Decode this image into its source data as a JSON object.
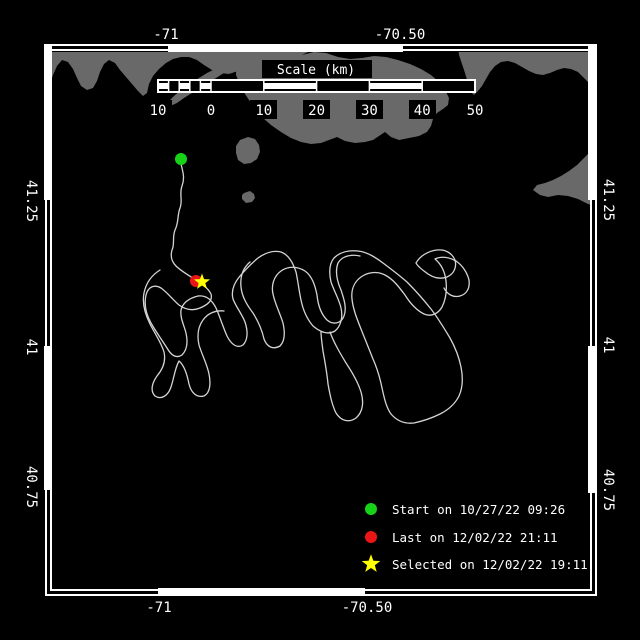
{
  "axes": {
    "top": [
      "-71",
      "-70.50"
    ],
    "bottom": [
      "-71",
      "-70.50"
    ],
    "left": [
      "41.25",
      "41",
      "40.75"
    ],
    "right": [
      "41.25",
      "41",
      "40.75"
    ]
  },
  "scale_bar": {
    "title": "Scale (km)",
    "tick_labels": [
      "10",
      "0",
      "10",
      "20",
      "30",
      "40",
      "50"
    ]
  },
  "legend": {
    "items": [
      {
        "marker": "green-dot",
        "label": "Start on 10/27/22 09:26"
      },
      {
        "marker": "red-dot",
        "label": "Last on 12/02/22 21:11"
      },
      {
        "marker": "yellow-star",
        "label": "Selected on 12/02/22 19:11"
      }
    ]
  },
  "markers": {
    "start": {
      "transform": "translate(181,159)"
    },
    "last": {
      "transform": "translate(196,281)"
    },
    "selected": {
      "transform": "translate(202,282)"
    }
  },
  "colors": {
    "background": "#000000",
    "frame": "#ffffff",
    "land": "#696969",
    "track": "#d4d4d4",
    "start_green": "#17d317",
    "last_red": "#ea1616",
    "selected_yellow": "#ffff00",
    "text": "#ffffff"
  },
  "geometry": {
    "land": [
      "47,48 312,48 308,52 300,56 292,59 283,58 273,56 263,58 254,62 246,67 238,71 229,74 220,73 212,70 204,65 197,60 189,57 181,57 173,59 166,63 159,69 153,76 149,84 147,93 143,96 138,91 132,84 126,77 120,70 115,63 109,60 104,64 100,72 97,81 93,88 87,90 81,86 77,78 73,69 68,62 62,60 57,66 53,75 50,84 47,91",
      "168,102 175,95 183,89 191,83 199,78 207,73 215,69 223,65 230,62 235,64 231,69 224,73 216,78 208,83 200,88 192,93 184,98 177,103 170,106",
      "236,64 244,58 254,54 266,52 278,53 290,56 302,55 314,52 326,53 338,57 350,59 362,58 374,56 386,57 398,60 410,64 421,69 431,75 439,82 445,90 449,98 448,105 443,109 437,113 433,119 431,126 427,132 419,136 409,138 399,140 391,137 385,132 379,136 373,140 365,142 355,143 345,141 337,137 329,140 321,143 311,144 301,142 291,138 281,132 271,125 263,118 257,111 251,103 245,94 240,85 236,75",
      "458,48 596,48 596,88 590,84 584,78 578,72 571,69 564,68 557,70 550,73 543,75 536,74 529,71 522,67 515,63 508,61 501,62 495,66 490,72 486,79 482,86 478,91 474,95 470,91 468,83 465,73 462,64 459,55",
      "596,150 596,206 588,204 578,199 568,196 558,195 548,197 540,195 533,190 537,185 545,183 553,180 561,176 569,171 577,165 584,158 590,152",
      "240,140 248,137 255,139 259,145 260,152 257,159 251,163 244,164 238,160 236,153 236,146",
      "244,193 250,191 254,194 255,198 252,202 246,203 242,199 242,195"
    ],
    "track": [
      "M181,164 C183,172 185,178 182,186 C179,194 183,200 180,208 C177,216 179,222 175,230 C172,238 175,244 172,250 C170,257 172,262 176,266 C181,271 188,275 196,280 C202,284 208,288 211,294 C213,301 207,305 200,308 C193,311 186,310 179,305 C173,300 168,293 161,288 C154,284 148,287 146,295 C144,304 146,314 151,323 C156,332 162,340 167,348 C171,355 176,359 182,355 C187,350 188,342 186,333 C184,325 180,318 181,310 C183,302 190,298 198,296 C206,295 212,300 216,308 C220,317 223,327 227,336 C231,344 237,349 243,345 C248,340 248,331 245,322 C242,314 236,307 233,299 C231,291 234,283 240,276 C246,269 252,263 258,258 C265,253 273,250 281,252 C289,255 293,263 296,272 C298,281 299,291 301,300 C303,310 307,319 313,326 C320,332 328,335 335,331 C341,326 343,317 341,308 C339,299 334,291 331,282 C329,273 329,264 334,258 C340,252 349,250 358,251 C367,252 375,257 383,263 C391,269 399,275 407,282 C415,290 423,299 431,309 C438,318 444,328 450,338 C455,347 459,357 461,367 C463,377 463,387 459,396 C455,404 448,410 440,414 C432,418 423,421 414,423 C405,424 397,421 391,414 C386,407 384,397 382,388 C380,378 377,368 373,359 C369,349 365,339 361,329 C357,319 353,309 352,299 C351,290 354,282 361,277 C368,272 377,271 385,275 C393,279 399,287 405,295 C410,303 416,310 424,314 C431,317 438,314 442,307 C446,299 447,290 446,281 C445,272 441,264 435,259 C441,256 449,257 456,261 C462,265 467,272 469,280 C470,288 467,294 460,296 C453,298 447,294 444,288",
      "M160,270 C152,275 146,283 144,293 C142,303 145,314 150,324 C155,334 161,342 164,352 C166,361 163,369 157,376 C152,383 150,391 155,396 C161,400 168,396 171,387 C174,378 175,368 179,361 C184,365 187,374 189,384 C191,392 196,398 204,396 C210,393 211,384 209,374 C207,364 202,355 199,345 C197,336 198,327 203,320 C208,313 216,310 224,311",
      "M250,262 C243,268 240,277 241,287 C242,297 247,305 253,313 C258,321 262,330 264,339 C267,347 273,350 280,346 C285,341 285,332 283,323 C280,313 275,304 273,294 C271,285 274,276 281,271 C288,266 297,266 305,271 C312,276 315,285 317,295 C318,305 321,314 327,320 C333,325 341,324 344,316 C347,308 344,299 341,290 C337,281 335,271 338,263 C342,256 351,254 360,256",
      "M330,332 C334,343 340,353 346,363 C352,372 358,382 361,392 C364,402 363,412 356,418 C349,423 341,421 336,413 C332,405 330,395 328,384 C327,373 325,362 323,351 C322,343 321,337 321,332",
      "M416,263 C420,256 428,251 437,250 C445,249 452,253 455,260 C457,267 454,274 447,277 C439,280 431,277 424,271 C420,268 417,265 416,263"
    ]
  }
}
